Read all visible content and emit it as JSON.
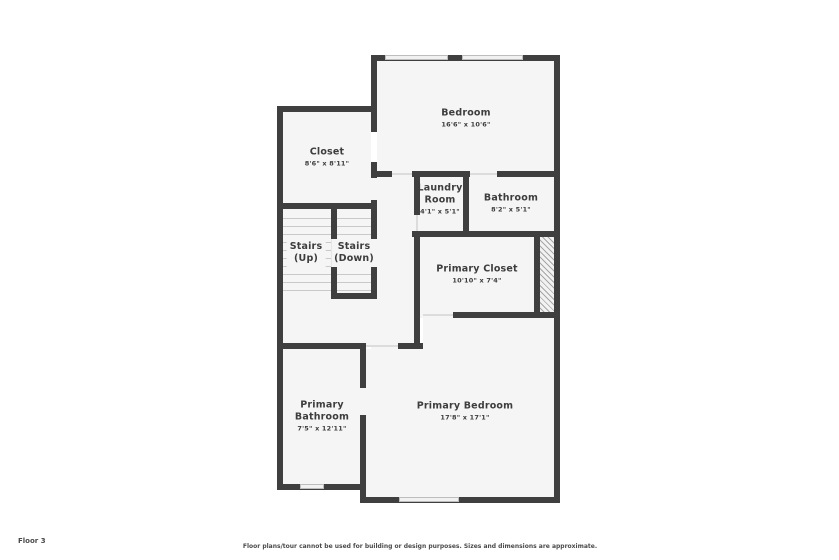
{
  "floor_label": "Floor 3",
  "disclaimer": "Floor plans/tour cannot be used for building or design purposes. Sizes and dimensions are approximate.",
  "rooms": {
    "bedroom": {
      "name": "Bedroom",
      "dims": "16'6\" x 10'6\""
    },
    "closet": {
      "name": "Closet",
      "dims": "8'6\" x 8'11\""
    },
    "laundry": {
      "name_line1": "Laundry",
      "name_line2": "Room",
      "dims": "4'1\" x 5'1\""
    },
    "bathroom": {
      "name": "Bathroom",
      "dims": "8'2\" x 5'1\""
    },
    "stairs_up": {
      "name_line1": "Stairs",
      "name_line2": "(Up)"
    },
    "stairs_down": {
      "name_line1": "Stairs",
      "name_line2": "(Down)"
    },
    "primary_closet": {
      "name": "Primary Closet",
      "dims": "10'10\" x 7'4\""
    },
    "primary_bathroom": {
      "name_line1": "Primary",
      "name_line2": "Bathroom",
      "dims": "7'5\" x 12'11\""
    },
    "primary_bedroom": {
      "name": "Primary Bedroom",
      "dims": "17'8\" x 17'1\""
    }
  },
  "palette": {
    "wall": "#3f3f3f",
    "floor": "#f5f5f5",
    "window_frame": "#bdbdbd",
    "stair_tread": "#c9c9c9",
    "text": "#3d3d3d"
  }
}
